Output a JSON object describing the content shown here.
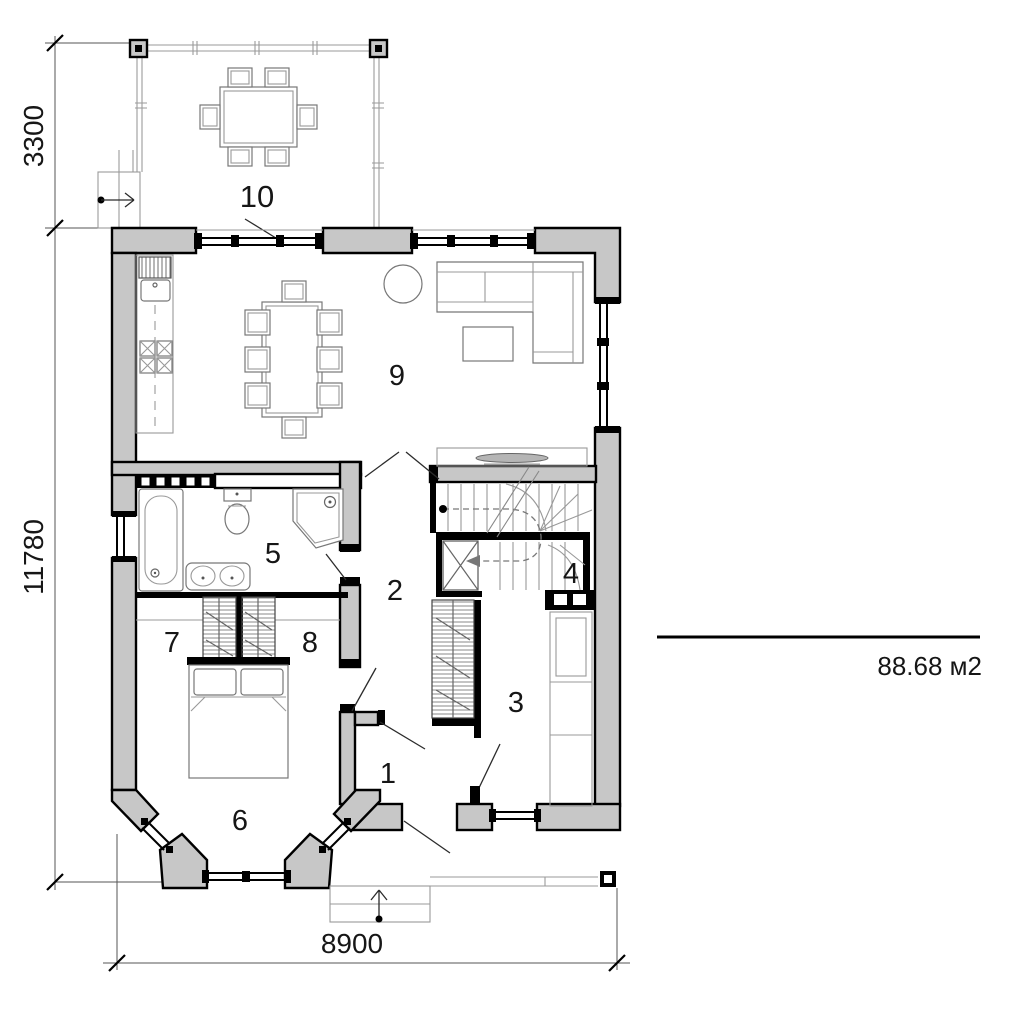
{
  "plan": {
    "room_numbers": {
      "r1": "1",
      "r2": "2",
      "r3": "3",
      "r4": "4",
      "r5": "5",
      "r6": "6",
      "r7": "7",
      "r8": "8",
      "r9": "9",
      "r10": "10"
    },
    "dimensions": {
      "terrace_depth": "3300",
      "house_depth": "11780",
      "house_width": "8900"
    },
    "area_note": "88.68 м2",
    "colors": {
      "wall_fill": "#c7c7c7",
      "wall_outline": "#000000",
      "background": "#ffffff"
    }
  }
}
